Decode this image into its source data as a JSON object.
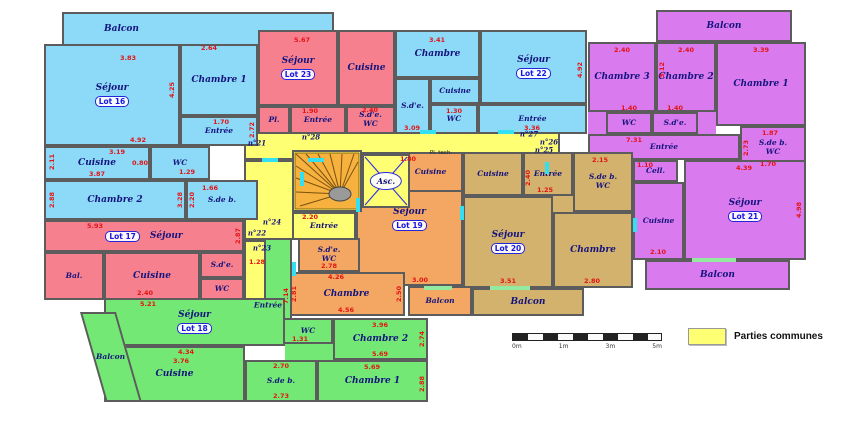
{
  "legend": {
    "label": "Parties communes",
    "swatch_color": "#FFFF73"
  },
  "scalebar": {
    "labels": [
      "0m",
      "1m",
      "3m",
      "5m"
    ]
  },
  "colors": {
    "lot16": "#8DD9F8",
    "lot17": "#F7808F",
    "lot18": "#74E874",
    "lot19": "#F4A763",
    "lot20": "#D2B26C",
    "lot21": "#D97AEE",
    "lot22": "#8DD9F8",
    "lot23": "#F7808F",
    "common": "#FFFF73",
    "wall": "#5C5C5C",
    "dimension_text": "#E31414",
    "room_text": "#14147E"
  },
  "common": {
    "elevator": "Asc.",
    "entree": "Entrée",
    "tech": "Pl. tech.",
    "doors": {
      "n21": "n°21",
      "n22": "n°22",
      "n23": "n°23",
      "n24": "n°24",
      "n25": "n°25",
      "n26": "n°26",
      "n27": "n°27",
      "n28": "n°28"
    },
    "dims": [
      "2.20",
      "1.28"
    ]
  },
  "lots": {
    "lot16": {
      "badge": "Lot 16",
      "rooms": {
        "balcon": "Balcon",
        "sejour": "Séjour",
        "chambre1": "Chambre 1",
        "entree": "Entrée",
        "cuisine": "Cuisine",
        "wc": "WC",
        "chambre2": "Chambre 2",
        "sdb": "S.de b."
      },
      "dims": [
        "3.83",
        "2.64",
        "4.25",
        "1.70",
        "2.72",
        "4.92",
        "3.19",
        "2.11",
        "0.80",
        "1.29",
        "3.87",
        "2.88",
        "3.28",
        "1.66",
        "2.20"
      ]
    },
    "lot17": {
      "badge": "Lot 17",
      "rooms": {
        "sejour": "Séjour",
        "bal": "Bal.",
        "cuisine": "Cuisine",
        "sde": "S.d'e.",
        "wc": "WC"
      },
      "dims": [
        "5.93",
        "2.87",
        "2.40"
      ]
    },
    "lot18": {
      "badge": "Lot 18",
      "rooms": {
        "sejour": "Séjour",
        "entree": "Entrée",
        "balcon": "Balcon",
        "cuisine": "Cuisine",
        "sdb": "S.de b.",
        "wc": "WC",
        "chambre2": "Chambre 2",
        "chambre1": "Chambre 1"
      },
      "dims": [
        "5.21",
        "7.14",
        "4.34",
        "3.76",
        "2.70",
        "2.73",
        "1.31",
        "3.96",
        "5.69",
        "5.69",
        "2.74",
        "2.88"
      ]
    },
    "lot19": {
      "badge": "Lot 19",
      "rooms": {
        "cuisine": "Cuisine",
        "sejour": "Séjour",
        "sde": "S.d'e.",
        "wc": "WC",
        "chambre": "Chambre",
        "balcon": "Balcon"
      },
      "dims": [
        "1.80",
        "3.00",
        "2.78",
        "4.26",
        "4.56",
        "2.81",
        "2.50"
      ]
    },
    "lot20": {
      "badge": "Lot 20",
      "rooms": {
        "cuisine": "Cuisine",
        "sejour": "Séjour",
        "entree": "Entrée",
        "sdb": "S.de b.",
        "wc": "WC",
        "chambre": "Chambre",
        "balcon": "Balcon"
      },
      "dims": [
        "2.15",
        "2.40",
        "1.25",
        "3.51",
        "2.80"
      ]
    },
    "lot21": {
      "badge": "Lot 21",
      "rooms": {
        "balcon_top": "Balcon",
        "chambre3": "Chambre 3",
        "chambre2": "Chambre 2",
        "chambre1": "Chambre 1",
        "wc": "WC",
        "sde": "S.d'e.",
        "entree": "Entrée",
        "cell": "Cell.",
        "cuisine": "Cuisine",
        "sejour": "Séjour",
        "sdb": "S.de b.",
        "wc2": "WC",
        "balcon_bottom": "Balcon"
      },
      "dims": [
        "2.40",
        "2.40",
        "3.39",
        "3.12",
        "1.40",
        "1.40",
        "7.31",
        "1.87",
        "2.73",
        "1.70",
        "1.10",
        "2.10",
        "4.39",
        "4.98"
      ]
    },
    "lot22": {
      "badge": "Lot 22",
      "rooms": {
        "chambre": "Chambre",
        "sejour": "Séjour",
        "cuisine": "Cuisine",
        "sde": "S.d'e.",
        "wc": "WC",
        "entree": "Entrée"
      },
      "dims": [
        "3.41",
        "4.92",
        "1.30",
        "3.09",
        "3.36"
      ]
    },
    "lot23": {
      "badge": "Lot 23",
      "rooms": {
        "sejour": "Séjour",
        "cuisine": "Cuisine",
        "pl": "Pl.",
        "entree": "Entrée",
        "sde": "S.d'e.",
        "wc": "WC"
      },
      "dims": [
        "5.67",
        "1.90",
        "2.40"
      ]
    }
  }
}
